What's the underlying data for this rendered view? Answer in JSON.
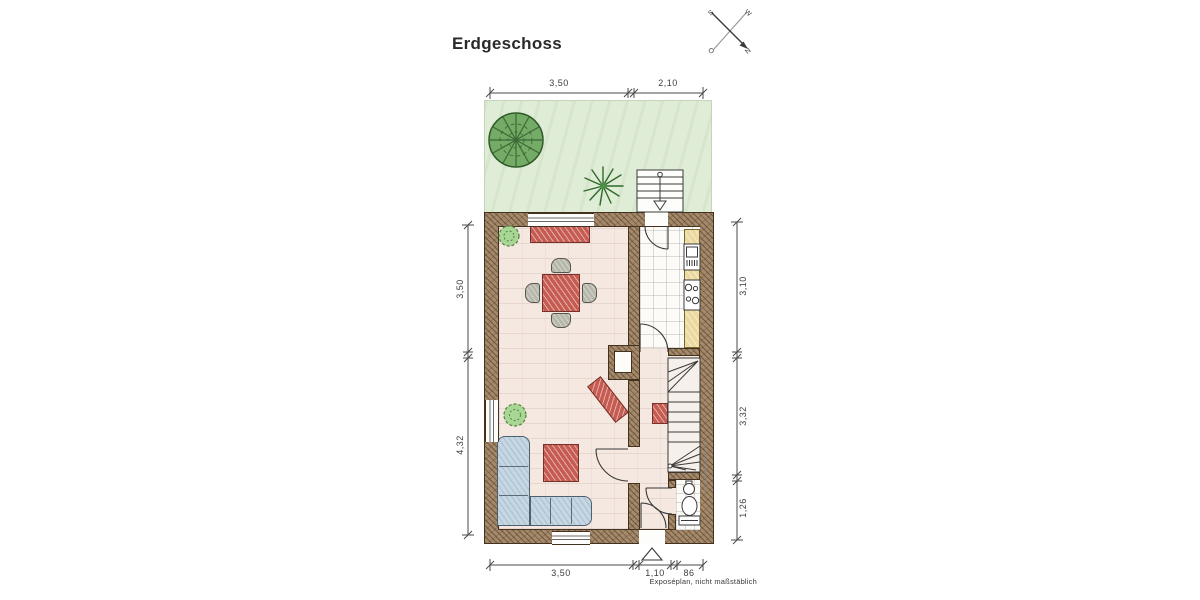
{
  "title": "Erdgeschoss",
  "footer_note": "Exposéplan, nicht maßstäblich",
  "side_watermark": "© ExposéPlan 24",
  "compass": {
    "north": "N",
    "south": "S",
    "east": "O",
    "west": "W"
  },
  "dimensions": {
    "top": [
      "3,50",
      "2,10"
    ],
    "left": [
      "3,50",
      "4,32"
    ],
    "right": [
      "3,10",
      "3,32",
      "1,26"
    ],
    "bottom": [
      "3,50",
      "1,10",
      "86"
    ]
  },
  "legend_colors": {
    "wall": "#a5896a",
    "floor": "#f4e8e1",
    "kitchen_tiles": "#fcfbf7",
    "garden": "#dfecd6",
    "furniture_red": "#c65c51",
    "sofa_blue": "#c6d7e4",
    "counter_yellow": "#ecd9a0",
    "tree_green": "#74ab67"
  }
}
